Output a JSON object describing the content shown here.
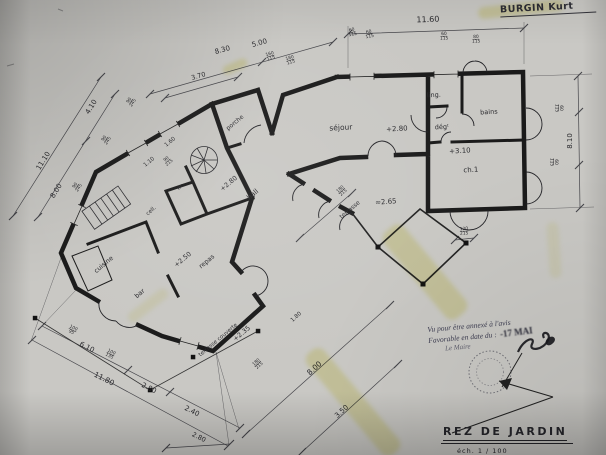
{
  "photo": {
    "paper_color": "#c9c8c4",
    "ink_color": "#1a1a1a",
    "highlight_color": "#e8e276"
  },
  "header": {
    "client_name": "BURGIN Kurt"
  },
  "title_block": {
    "title": "REZ DE JARDIN",
    "scale": "éch.  1 / 100"
  },
  "approval_stamp": {
    "line1": "Vu pour être annexé à l'avis",
    "line2": "Favorable en date du :",
    "date": "-17 MAI",
    "line3": "Le Maire"
  },
  "plan": {
    "labels": [
      {
        "t": "séjour",
        "x": 341,
        "y": 130,
        "r": -3,
        "s": 7.5,
        "k": "room"
      },
      {
        "t": "+2.80",
        "x": 397,
        "y": 131,
        "r": -3,
        "s": 7,
        "k": "level"
      },
      {
        "t": "ling.",
        "x": 434,
        "y": 97,
        "r": -3,
        "s": 6.5,
        "k": "room"
      },
      {
        "t": "bains",
        "x": 489,
        "y": 114,
        "r": -3,
        "s": 6.5,
        "k": "room"
      },
      {
        "t": "dégᵗ",
        "x": 442,
        "y": 129,
        "r": -3,
        "s": 6.5,
        "k": "room"
      },
      {
        "t": "+3.10",
        "x": 460,
        "y": 153,
        "r": -3,
        "s": 7,
        "k": "level"
      },
      {
        "t": "ch.1",
        "x": 471,
        "y": 172,
        "r": -3,
        "s": 7,
        "k": "room"
      },
      {
        "t": "porche",
        "x": 236,
        "y": 124,
        "r": -40,
        "s": 6,
        "k": "room"
      },
      {
        "t": "+2.80",
        "x": 230,
        "y": 185,
        "r": -40,
        "s": 6.5,
        "k": "level"
      },
      {
        "t": "hall",
        "x": 254,
        "y": 196,
        "r": -40,
        "s": 7,
        "k": "room"
      },
      {
        "t": "wc",
        "x": 181,
        "y": 188,
        "r": -40,
        "s": 5,
        "k": "room"
      },
      {
        "t": "cell.",
        "x": 152,
        "y": 212,
        "r": -40,
        "s": 5.5,
        "k": "room"
      },
      {
        "t": "cuisine",
        "x": 105,
        "y": 266,
        "r": -40,
        "s": 6.5,
        "k": "room"
      },
      {
        "t": "+2.50",
        "x": 184,
        "y": 261,
        "r": -40,
        "s": 6.5,
        "k": "level"
      },
      {
        "t": "repas",
        "x": 208,
        "y": 263,
        "r": -40,
        "s": 6.5,
        "k": "room"
      },
      {
        "t": "bar",
        "x": 141,
        "y": 295,
        "r": -40,
        "s": 6.5,
        "k": "room"
      },
      {
        "t": "terrasse",
        "x": 351,
        "y": 211,
        "r": -40,
        "s": 6,
        "k": "room"
      },
      {
        "t": "≈2.65",
        "x": 386,
        "y": 204,
        "r": -5,
        "s": 7,
        "k": "level"
      },
      {
        "t": "terrasse couverte",
        "x": 219,
        "y": 341,
        "r": -40,
        "s": 5.5,
        "k": "room"
      },
      {
        "t": "+2.35",
        "x": 243,
        "y": 335,
        "r": -40,
        "s": 6.5,
        "k": "level"
      },
      {
        "t": "11.60",
        "x": 428,
        "y": 22,
        "r": -2,
        "s": 8,
        "k": "dim"
      },
      {
        "t": "8.30",
        "x": 223,
        "y": 52,
        "r": -16,
        "s": 7,
        "k": "dim"
      },
      {
        "t": "5.00",
        "x": 260,
        "y": 45,
        "r": -16,
        "s": 7,
        "k": "dim"
      },
      {
        "t": "3.70",
        "x": 199,
        "y": 78,
        "r": -16,
        "s": 6.5,
        "k": "dim"
      },
      {
        "t": "11.10",
        "x": 45,
        "y": 162,
        "r": -58,
        "s": 7,
        "k": "dim"
      },
      {
        "t": "8.00",
        "x": 58,
        "y": 192,
        "r": -58,
        "s": 7,
        "k": "dim"
      },
      {
        "t": "4.10",
        "x": 93,
        "y": 108,
        "r": -58,
        "s": 7,
        "k": "dim"
      },
      {
        "t": "1.60",
        "x": 171,
        "y": 143,
        "r": -40,
        "s": 5.5,
        "k": "dim"
      },
      {
        "t": "1.10",
        "x": 150,
        "y": 163,
        "r": -40,
        "s": 5.5,
        "k": "dim"
      },
      {
        "t": "8.10",
        "x": 572,
        "y": 141,
        "r": -90,
        "s": 7,
        "k": "dim"
      },
      {
        "t": "6.10",
        "x": 86,
        "y": 349,
        "r": 27,
        "s": 7,
        "k": "dim"
      },
      {
        "t": "11.80",
        "x": 103,
        "y": 381,
        "r": 27,
        "s": 7.5,
        "k": "dim"
      },
      {
        "t": "2.80",
        "x": 148,
        "y": 390,
        "r": 27,
        "s": 7,
        "k": "dim"
      },
      {
        "t": "2.40",
        "x": 191,
        "y": 413,
        "r": 27,
        "s": 7,
        "k": "dim"
      },
      {
        "t": "2.80",
        "x": 198,
        "y": 439,
        "r": 27,
        "s": 6.5,
        "k": "dim"
      },
      {
        "t": "8.00",
        "x": 316,
        "y": 370,
        "r": -42,
        "s": 7.5,
        "k": "dim"
      },
      {
        "t": "3.50",
        "x": 343,
        "y": 413,
        "r": -42,
        "s": 7,
        "k": "dim"
      },
      {
        "t": "1.80",
        "x": 297,
        "y": 318,
        "r": -42,
        "s": 5.5,
        "k": "dim"
      },
      {
        "t": "60/115",
        "x": 352,
        "y": 31,
        "r": -12,
        "f": 1,
        "k": "dim"
      },
      {
        "t": "60/115",
        "x": 369,
        "y": 33,
        "r": -12,
        "f": 1,
        "k": "dim"
      },
      {
        "t": "60/115",
        "x": 444,
        "y": 35,
        "r": -3,
        "f": 1,
        "k": "dim"
      },
      {
        "t": "80/115",
        "x": 476,
        "y": 38,
        "r": -3,
        "f": 1,
        "k": "dim"
      },
      {
        "t": "160/115",
        "x": 270,
        "y": 55,
        "r": -16,
        "f": 1,
        "k": "dim"
      },
      {
        "t": "180/115",
        "x": 290,
        "y": 59,
        "r": -16,
        "f": 1,
        "k": "dim"
      },
      {
        "t": "90/245",
        "x": 130,
        "y": 101,
        "r": -58,
        "f": 1,
        "k": "dim"
      },
      {
        "t": "90/245",
        "x": 105,
        "y": 139,
        "r": -58,
        "f": 1,
        "k": "dim"
      },
      {
        "t": "90/245",
        "x": 76,
        "y": 186,
        "r": -58,
        "f": 1,
        "k": "dim"
      },
      {
        "t": "90/215",
        "x": 167,
        "y": 160,
        "r": -40,
        "f": 1,
        "k": "dim"
      },
      {
        "t": "60/115",
        "x": 560,
        "y": 108,
        "r": 90,
        "f": 1,
        "k": "dim"
      },
      {
        "t": "60/115",
        "x": 555,
        "y": 162,
        "r": 90,
        "f": 1,
        "k": "dim"
      },
      {
        "t": "120/215",
        "x": 464,
        "y": 230,
        "r": -3,
        "f": 1,
        "k": "dim"
      },
      {
        "t": "180/215",
        "x": 341,
        "y": 190,
        "r": -42,
        "f": 1,
        "k": "dim"
      },
      {
        "t": "180/215",
        "x": 257,
        "y": 363,
        "r": -42,
        "f": 1,
        "k": "dim"
      },
      {
        "t": "100/95",
        "x": 73,
        "y": 329,
        "r": 27,
        "f": 1,
        "k": "dim"
      },
      {
        "t": "100/135",
        "x": 111,
        "y": 353,
        "r": 27,
        "f": 1,
        "k": "dim"
      }
    ]
  }
}
